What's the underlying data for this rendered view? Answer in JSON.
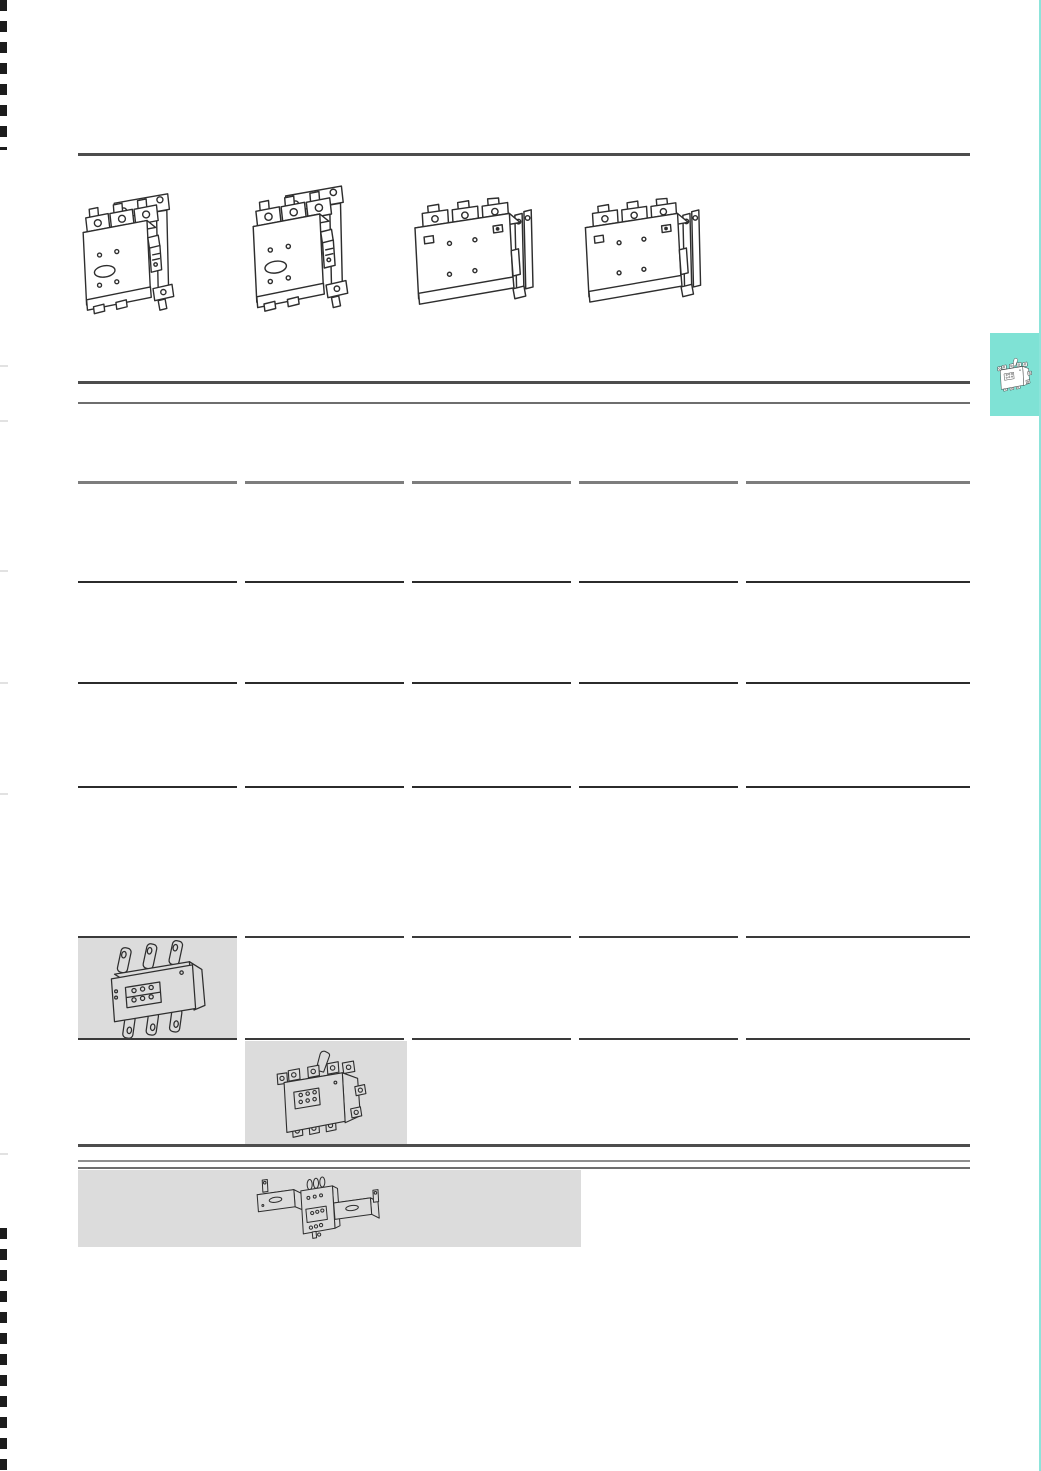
{
  "page": {
    "kind": "product-catalog-page",
    "visible_text": "",
    "note": "graphics-only catalog sheet: technical line drawings, table rules, shaded cells, chapter thumb tab"
  },
  "colors": {
    "background": "#ffffff",
    "rule_heavy": "#4d4d4d",
    "rule_mid": "#6e6e6e",
    "rule_thin": "#8f8f8f",
    "segment_dark": "#2b2b2b",
    "shaded_cell": "#dcdcdc",
    "accent_teal": "#7fe2d5",
    "line_art": "#2e2e2e",
    "crop_mark": "#1c1c1c"
  },
  "product_gallery": {
    "items": [
      {
        "icon": "contactor-frame-mount-icon",
        "label": "contactor with mounting frame, 3-pole"
      },
      {
        "icon": "contactor-frame-mount-large-icon",
        "label": "large contactor with mounting frame, 3-pole"
      },
      {
        "icon": "contactor-block-icon",
        "label": "block-frame contactor"
      },
      {
        "icon": "contactor-block-large-icon",
        "label": "large block-frame contactor"
      }
    ]
  },
  "spec_table": {
    "column_count": 5,
    "segment_row_count": 6,
    "shaded_cells": [
      {
        "column": 1,
        "icon": "overload-relay-strap-terminals-icon",
        "label": "overload relay with strap terminals"
      },
      {
        "column": 2,
        "icon": "overload-relay-reset-lever-icon",
        "label": "overload relay with reset lever"
      }
    ]
  },
  "bottom_band": {
    "icon": "overload-relay-busbar-icon",
    "label": "busbar-mounted overload relay assembly"
  },
  "side_tab": {
    "icon": "overload-relay-tab-icon",
    "label": "chapter thumb tab: overload relays",
    "color": "#7fe2d5"
  }
}
